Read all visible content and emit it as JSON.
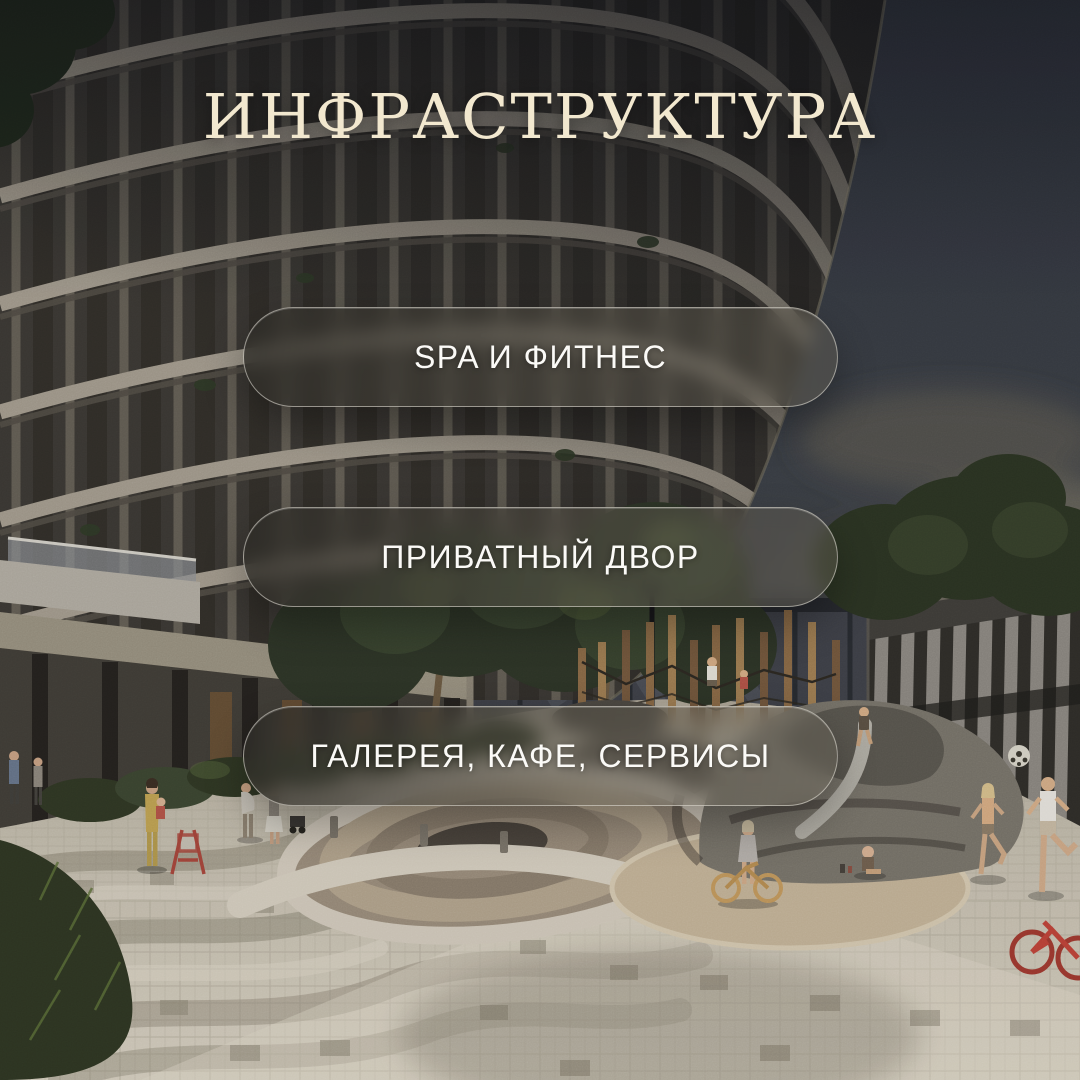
{
  "page": {
    "title": "ИНФРАСТРУКТУРА"
  },
  "buttons": [
    {
      "label": "SPA И ФИТНЕС"
    },
    {
      "label": "ПРИВАТНЫЙ ДВОР"
    },
    {
      "label": "ГАЛЕРЕЯ, КАФЕ, СЕРВИСЫ"
    }
  ],
  "colors": {
    "title_text": "#f2e8cf",
    "button_text": "#fbfaf7",
    "button_border": "rgba(235,232,222,0.55)",
    "button_glass": "rgba(66,62,54,0.6)"
  }
}
